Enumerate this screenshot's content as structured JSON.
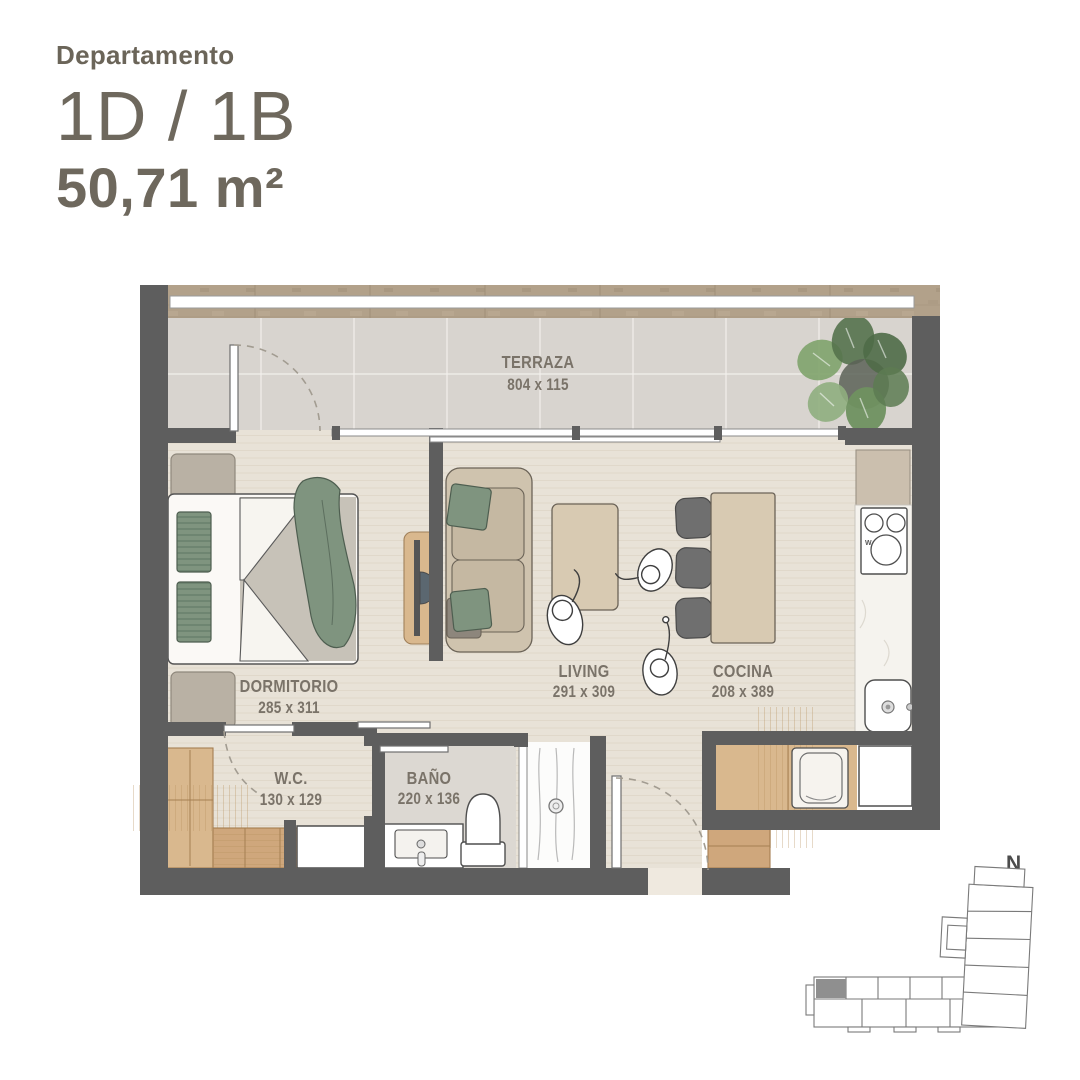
{
  "header": {
    "label": "Departamento",
    "unit": "1D / 1B",
    "area": "50,71 m²"
  },
  "rooms": [
    {
      "name": "TERRAZA",
      "dims": "804 x 115"
    },
    {
      "name": "DORMITORIO",
      "dims": "285 x 311"
    },
    {
      "name": "LIVING",
      "dims": "291 x 309"
    },
    {
      "name": "COCINA",
      "dims": "208 x 389"
    },
    {
      "name": "W.C.",
      "dims": "130 x 129"
    },
    {
      "name": "BAÑO",
      "dims": "220 x 136"
    }
  ],
  "kitchen": {
    "cooktop_mark": "W"
  },
  "compass": {
    "label": "N"
  },
  "palette": {
    "wall": "#5e5e5e",
    "band": "#b2a18a",
    "floor": "#e8e2d7",
    "terrace": "#d8d4cf",
    "bath": "#dcd8d2",
    "marble": "#f5f3ee",
    "wood": "#d9b88e",
    "wood2": "#cfa77c",
    "sofa": "#cfc3ae",
    "cushion": "#c5b8a2",
    "table": "#d8cab2",
    "chair": "#6f6f6f",
    "green": "#7f947f",
    "blanket": "#c7c2b8",
    "label": "#7a7369",
    "title": "#6c665b",
    "line": "#4f4f4f",
    "dash": "#a29c91",
    "keyfill": "#8f8f8f",
    "keyline": "#7a7a7a"
  }
}
